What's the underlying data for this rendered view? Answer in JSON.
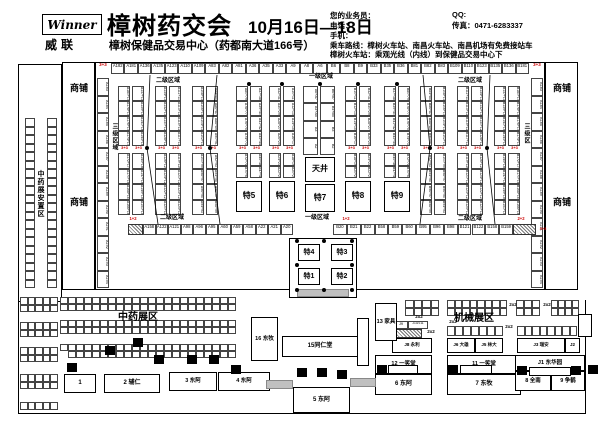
{
  "header": {
    "logo_text": "Winner",
    "logo_sub": "威联",
    "title": "樟树药交会",
    "title_dates": "10月16日—18日",
    "subtitle": "樟树保健品交易中心（药都南大道166号）",
    "agent": "您的业务员：",
    "qq": "QQ:",
    "phone": "电话：",
    "fax": "传真：0471-6283337",
    "mobile": "手机：",
    "route1": "乘车路线：樟树火车站、南昌火车站、南昌机场有免费接站车",
    "route2": "樟树火车站：乘观光线（内线）到保健品交易中心下"
  },
  "plan": {
    "shangpu": "商铺",
    "anzhiqu": "中药展安置区",
    "level1": "一级区域",
    "level2": "二级区域",
    "level3_left": "三级区域",
    "level3_right": "三级区",
    "tianjing": "天井",
    "te": {
      "t1": "特1",
      "t2": "特2",
      "t3": "特3",
      "t4": "特4",
      "t5": "特5",
      "t6": "特6",
      "t7": "特7",
      "t8": "特8",
      "t9": "特9"
    },
    "red": {
      "r33": "3+3",
      "r12": "1+2",
      "r22": "2+2"
    },
    "top_row": [
      "A182",
      "A181",
      "A136",
      "A135",
      "A123",
      "A110",
      "A109",
      "A83",
      "A82",
      "A81",
      "A36",
      "A35",
      "A33",
      "A9",
      "A8",
      "A6",
      "B6",
      "B8",
      "B9",
      "B33",
      "B35",
      "B36",
      "B81",
      "B82",
      "B83",
      "B109",
      "B110",
      "B123",
      "B135",
      "B136",
      "B181"
    ],
    "bottom_row_left": [
      "A158",
      "A122",
      "A121",
      "A98",
      "A96",
      "A95",
      "A60",
      "A59",
      "A58",
      "A22",
      "A21",
      "A20"
    ],
    "bottom_row_right": [
      "B20",
      "B21",
      "B22",
      "B58",
      "B59",
      "B60",
      "B95",
      "B96",
      "B98",
      "B121",
      "B122",
      "B158",
      "B159"
    ],
    "wall_left": [
      "A183",
      "A184",
      "A185",
      "A186",
      "A187",
      "A188",
      "A189",
      "A190",
      "A191",
      "A192",
      "A193",
      "A194"
    ],
    "wall_right": [
      "B183",
      "B184",
      "B185",
      "B186",
      "B187",
      "B188",
      "B189",
      "B190",
      "B191",
      "B192",
      "B193",
      "B194"
    ],
    "groups": {
      "g1": {
        "left": [
          "A180+179",
          "A178+177",
          "A176+175",
          "A174+173",
          "A172+171",
          "A170+169",
          "A168+167",
          "A166+165"
        ],
        "right": [
          "A137+138",
          "A139+140",
          "A141+142",
          "A143+144",
          "A145+146",
          "A147+148",
          "A149+150",
          "A151+152"
        ]
      },
      "g2": {
        "left": [
          "A134+133",
          "A132+131",
          "A130+129",
          "A128+127",
          "A126+125",
          "A124+123",
          "A122+121",
          "A120+119"
        ],
        "right": [
          "A111+112",
          "A113+114",
          "A115+116",
          "A117+118",
          "A119+120",
          "A121+122",
          "A123+124",
          "A125+126"
        ]
      },
      "g3": {
        "left": [
          "A108+107",
          "A106+105",
          "A104+103",
          "A102+101",
          "A100+99",
          "A98+97",
          "A96+95",
          "A94+93"
        ],
        "right": [
          "A84+85",
          "A86+87",
          "A88+89",
          "A90+91",
          "A92+93",
          "A94+95",
          "A96+97",
          "A98+99"
        ]
      },
      "g4": {
        "left": [
          "A80+79",
          "A78+77",
          "A76+75",
          "A74+73",
          "A72+71",
          "A70+69"
        ],
        "right": [
          "A37+38",
          "A39+40",
          "A41+42",
          "A43+44",
          "A45+46",
          "A47+48"
        ]
      },
      "g5": {
        "left": [
          "A32+31",
          "A30+29",
          "A28+27",
          "A26+25",
          "A24+23",
          "A22+21"
        ],
        "right": [
          "A10+11",
          "A12+13",
          "A14+15",
          "A16+17",
          "A18+19",
          "A20+21"
        ]
      },
      "center": {
        "left": [
          "A6+A7",
          "A4+A5",
          "A3",
          "A2"
        ],
        "right": [
          "B6+B7",
          "B4+B5",
          "B3",
          "B2"
        ]
      },
      "g6": {
        "left": [
          "B10+11",
          "B12+13",
          "B14+15",
          "B16+17",
          "B18+19",
          "B20+21"
        ],
        "right": [
          "B32+31",
          "B30+29",
          "B28+27",
          "B26+25",
          "B24+23",
          "B22+21"
        ]
      },
      "g7": {
        "left": [
          "B37+38",
          "B39+40",
          "B41+42",
          "B43+44",
          "B45+46",
          "B47+48"
        ],
        "right": [
          "B80+79",
          "B78+77",
          "B76+75",
          "B74+73",
          "B72+71",
          "B70+69"
        ]
      },
      "g8": {
        "left": [
          "B84+85",
          "B86+87",
          "B88+89",
          "B90+91",
          "B92+93",
          "B94+95",
          "B96+97",
          "B98+99"
        ],
        "right": [
          "B108+107",
          "B106+105",
          "B104+103",
          "B102+101",
          "B100+99",
          "B98+97",
          "B96+95",
          "B94+93"
        ]
      },
      "g9": {
        "left": [
          "B111+112",
          "B113+114",
          "B115+116",
          "B117+118",
          "B119+120",
          "B121+122",
          "B123+124",
          "B125+126"
        ],
        "right": [
          "B134+133",
          "B132+131",
          "B130+129",
          "B128+127",
          "B126+125",
          "B124+123",
          "B122+121",
          "B120+119"
        ]
      },
      "g10": {
        "left": [
          "B137+138",
          "B139+140",
          "B141+142",
          "B143+144",
          "B145+146",
          "B147+148",
          "B149+150",
          "B151+152"
        ],
        "right": [
          "B180+179",
          "B178+177",
          "B176+175",
          "B174+173",
          "B172+171",
          "B170+169",
          "B168+167",
          "B166+165"
        ]
      }
    }
  },
  "bottom": {
    "zhongyao": "中药展区",
    "jixie": "机械展区",
    "m2x2": "2x2",
    "blocks": {
      "b1": "1",
      "b2": "2 辅仁",
      "b3": "3 东阿",
      "b4": "4 东阿",
      "b5": "5 东阿",
      "b6": "6 东阿",
      "b7": "7 东牧",
      "b8": "8 全南",
      "b9": "9 争鹤",
      "b11": "11 一笑堂",
      "b12": "12 一笑堂",
      "b13": "13 家具",
      "b15": "15同仁堂",
      "b16": "16 东牧",
      "j1": "J1 东华园",
      "j2": "J2",
      "j3": "J3 瑞安",
      "j5": "J5 林大",
      "j6": "J6 大雄",
      "j8": "J8 永利",
      "j9": "J9",
      "j1011": "J10/J11"
    }
  }
}
